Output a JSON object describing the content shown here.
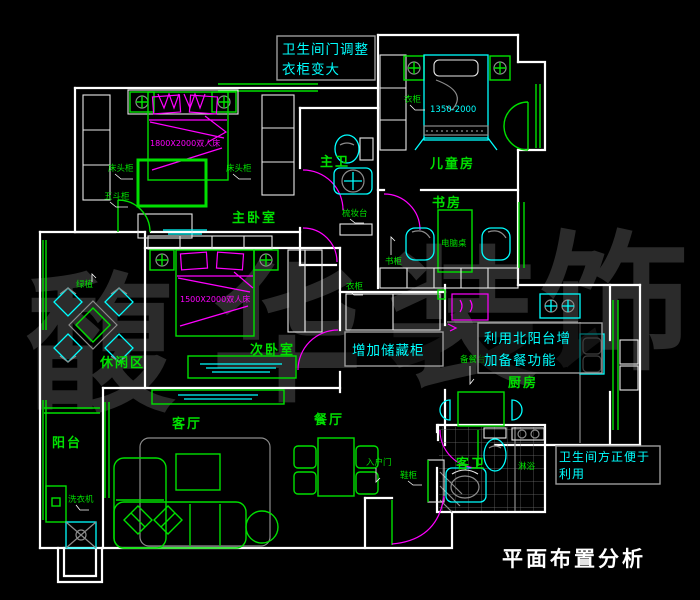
{
  "title": "平面布置分析",
  "watermark": {
    "chars": [
      "馥",
      "华",
      "装",
      "饰"
    ]
  },
  "annotations": {
    "bath_door": {
      "line1": "卫生间门调整",
      "line2": "衣柜变大"
    },
    "storage": {
      "text": "增加储藏柜"
    },
    "north_balcony": {
      "line1": "利用北阳台增",
      "line2": "加备餐功能"
    },
    "guest_bath": {
      "line1": "卫生间方正便于",
      "line2": "利用"
    }
  },
  "rooms": {
    "master_bedroom": "主卧室",
    "master_bath": "主卫",
    "kids_room": "儿童房",
    "study": "书房",
    "second_bedroom": "次卧室",
    "leisure": "休闲区",
    "balcony": "阳台",
    "living": "客厅",
    "dining": "餐厅",
    "kitchen": "厨房",
    "guest_bath": "客卫"
  },
  "furniture": {
    "master_bed": "1800X2000双人床",
    "second_bed": "1500X2000双人床",
    "kids_bed": "1350-2000",
    "nightstand": "床头柜",
    "chest": "五斗柜",
    "dresser": "梳妆台",
    "wardrobe_kids": "衣柜",
    "wardrobe_hall": "衣柜",
    "desk": "电脑桌",
    "bookcase": "书柜",
    "prep_counter": "备餐台",
    "entry_door": "入户门",
    "shoe_cabinet": "鞋柜",
    "washer": "洗衣机",
    "plant": "绿植",
    "shower": "淋浴"
  },
  "colors": {
    "background": "#000000",
    "wall": "#ffffff",
    "furniture_green": "#00e000",
    "cyan": "#00ffff",
    "magenta": "#ff00ff",
    "hatch_gray": "#8c8c8c",
    "annotation_border": "#9c9c9c",
    "watermark": "#2b2b2b",
    "title_text": "#ffffff"
  }
}
